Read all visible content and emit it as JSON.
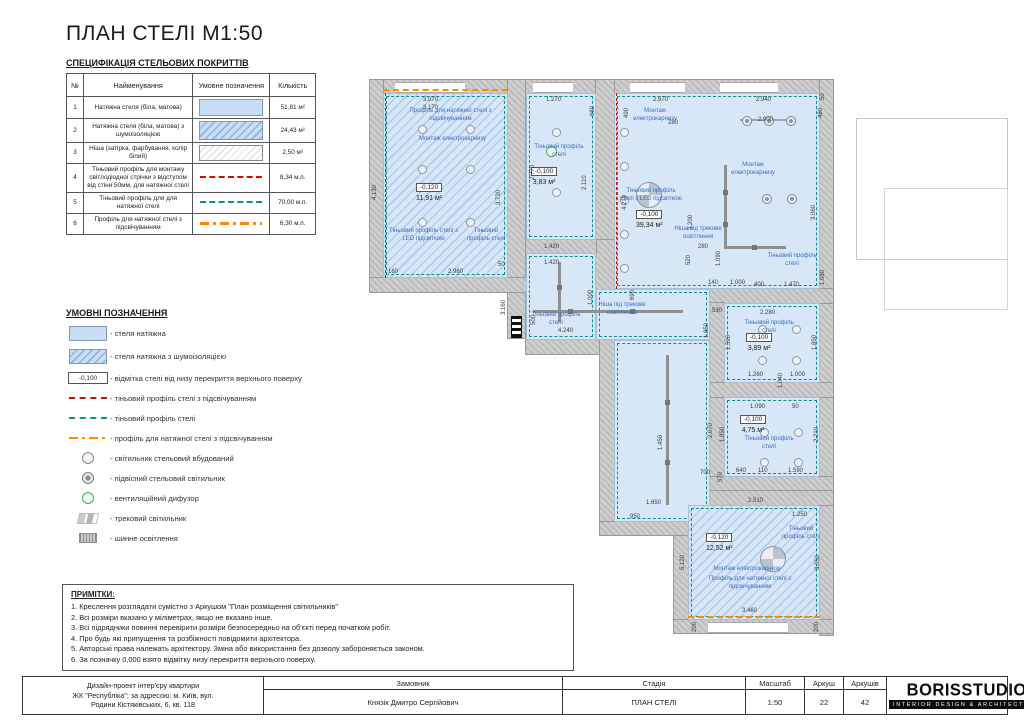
{
  "title": "ПЛАН СТЕЛІ М1:50",
  "colors": {
    "ceiling_fill": "#d8e7f8",
    "teal_profile": "#0d8f8f",
    "red_profile": "#cc1100",
    "orange_profile": "#ff8a00",
    "annotation_blue": "#3a6bbf",
    "diffuser_green": "#44b04a",
    "wall_gray": "#cfcfcf"
  },
  "spec_table": {
    "title": "СПЕЦИФІКАЦІЯ СТЕЛЬОВИХ ПОКРИТТІВ",
    "headers": [
      "№",
      "Найменування",
      "Умовне позначення",
      "Кількість"
    ],
    "rows": [
      {
        "no": "1",
        "name": "Натяжна стеля (біла, матова)",
        "swatch": "ceiling-plain",
        "qty": "51,81 м²"
      },
      {
        "no": "2",
        "name": "Натяжна стеля (біла, матова) з шумоізоляцією",
        "swatch": "ceiling-noise",
        "qty": "24,43 м²"
      },
      {
        "no": "3",
        "name": "Ніша (затірка, фарбування, колір білий)",
        "swatch": "niche-hatch",
        "qty": "2,50 м²"
      },
      {
        "no": "4",
        "name": "Тіньовий профіль для монтажу світлодіодної стрічки з відступом від стіни 50мм, для натяжної стелі",
        "swatch": "red-dashed",
        "qty": "8,34 м.п."
      },
      {
        "no": "5",
        "name": "Тіньовий профіль для для натяжної стелі",
        "swatch": "teal-dashed",
        "qty": "70,00 м.п."
      },
      {
        "no": "6",
        "name": "Профіль для натяжної стелі з підсвічуванням",
        "swatch": "orange-dashdot",
        "qty": "6,30 м.п."
      }
    ]
  },
  "legend": {
    "title": "УМОВНІ ПОЗНАЧЕННЯ",
    "items": [
      {
        "icon": "ceiling-plain",
        "label": "- стеля натяжна"
      },
      {
        "icon": "ceiling-noise",
        "label": "- стеля натяжна з шумоізоляцією"
      },
      {
        "icon": "elev-box",
        "icon_text": "-0,100",
        "label": "- відмітка стелі від низу перекриття верхнього поверху"
      },
      {
        "icon": "red-dashed",
        "label": "- тіньовий профіль стелі з підсвічуванням"
      },
      {
        "icon": "teal-dashed",
        "label": "- тіньовий профіль стелі"
      },
      {
        "icon": "orange-dashdot",
        "label": "- профіль для натяжної стелі з підсвічуванням"
      },
      {
        "icon": "downlight",
        "label": "- світильник стельовий вбудований"
      },
      {
        "icon": "pendant",
        "label": "- підвісний стельовий світильник"
      },
      {
        "icon": "diffuser",
        "label": "- вентиляційний дифузор"
      },
      {
        "icon": "track",
        "label": "- трековий світильник"
      },
      {
        "icon": "busbar",
        "label": "- шинне освітлення"
      }
    ]
  },
  "notes": {
    "title": "ПРИМІТКИ:",
    "lines": [
      "1. Креслення розглядати сумістно з Аркушом \"План розміщення світильників\"",
      "2. Всі розміри вказано у міліметрах, якщо не вказано інше.",
      "3. Всі підрядники повинні перевірити розміри безпосередньо на об'єкті перед початком робіт.",
      "4. Про будь які припущення та розбіжності повідомити архітектора.",
      "5. Авторські права належать архітектору. Зміна або використання без дозволу забороняється законом.",
      "6. За позначку 0,000 взято відмітку низу перекриття верхнього поверху."
    ]
  },
  "title_block": {
    "project_lines": [
      "Дизайн-проект інтер'єру квартири",
      "ЖК \"Республіка\"; за адресою: м. Київ, вул.",
      "Родини Кістяківських, 6, кв. 118"
    ],
    "client_label": "Замовник",
    "client_value": "Князік Дмитро Сергійович",
    "stage_label": "Стадія",
    "stage_value": "ПЛАН СТЕЛІ",
    "scale_label": "Масштаб",
    "scale_value": "1:50",
    "sheet_label": "Аркуш",
    "sheet_value": "22",
    "sheets_label": "Аркушів",
    "sheets_value": "42",
    "logo": "BORISSTUDIO",
    "logo_sub": "INTERIOR DESIGN & ARCHITECTURE"
  },
  "plan": {
    "rooms": [
      {
        "elev": "-0,120",
        "area": "11,91 м²",
        "x": 48,
        "y": 106
      },
      {
        "elev": "-0,100",
        "area": "3,83 м²",
        "x": 163,
        "y": 90
      },
      {
        "elev": "-0,100",
        "area": "39,34 м²",
        "x": 268,
        "y": 133
      },
      {
        "elev": "-0,100",
        "area": "3,89 м²",
        "x": 378,
        "y": 256
      },
      {
        "elev": "-0,100",
        "area": "4,75 м²",
        "x": 372,
        "y": 338
      },
      {
        "elev": "-0,120",
        "area": "12,52 м²",
        "x": 338,
        "y": 456
      }
    ],
    "annotations": [
      {
        "t": "Профіль для натяжної стелі з підсвічуванням",
        "x": 35,
        "y": 38,
        "w": 95
      },
      {
        "t": "Монтаж електрокарнизу",
        "x": 42,
        "y": 66,
        "w": 85
      },
      {
        "t": "Тіньовий профіль стелі з LED підсвіткою",
        "x": 18,
        "y": 158,
        "w": 75
      },
      {
        "t": "Тіньовий профіль стелі",
        "x": 96,
        "y": 158,
        "w": 44
      },
      {
        "t": "Тіньовий профіль стелі",
        "x": 160,
        "y": 74,
        "w": 62
      },
      {
        "t": "Монтаж електрокарнизу",
        "x": 256,
        "y": 38,
        "w": 62
      },
      {
        "t": "Тіньовий профіль стелі з LED підсвіткою",
        "x": 252,
        "y": 118,
        "w": 62
      },
      {
        "t": "Монтаж електрокарнизу",
        "x": 352,
        "y": 92,
        "w": 66
      },
      {
        "t": "Тіньовий профіль стелі",
        "x": 398,
        "y": 183,
        "w": 52
      },
      {
        "t": "Ніша під трекове освітлення",
        "x": 298,
        "y": 156,
        "w": 64
      },
      {
        "t": "Ніша під трекове освітлення",
        "x": 220,
        "y": 232,
        "w": 68
      },
      {
        "t": "Тіньовий профіль стелі",
        "x": 160,
        "y": 242,
        "w": 56
      },
      {
        "t": "Тіньовий профіль стелі",
        "x": 376,
        "y": 250,
        "w": 50
      },
      {
        "t": "Тіньовий профіль стелі",
        "x": 376,
        "y": 366,
        "w": 50
      },
      {
        "t": "Тіньовий профіль стелі",
        "x": 410,
        "y": 456,
        "w": 46
      },
      {
        "t": "Монтаж електрокарнизу",
        "x": 336,
        "y": 496,
        "w": 86
      },
      {
        "t": "Профіль для натяжної стелі з підсвічуванням",
        "x": 330,
        "y": 506,
        "w": 104
      }
    ],
    "dims": [
      {
        "t": "3.070",
        "x": 55,
        "y": 27
      },
      {
        "t": "3.170",
        "x": 55,
        "y": 35
      },
      {
        "t": "1.270",
        "x": 178,
        "y": 27
      },
      {
        "t": "660",
        "x": 222,
        "y": 46,
        "v": true
      },
      {
        "t": "2.970",
        "x": 285,
        "y": 27
      },
      {
        "t": "490",
        "x": 256,
        "y": 48,
        "v": true
      },
      {
        "t": "280",
        "x": 300,
        "y": 50
      },
      {
        "t": "2.940",
        "x": 388,
        "y": 27
      },
      {
        "t": "2.900",
        "x": 390,
        "y": 47
      },
      {
        "t": "480",
        "x": 450,
        "y": 48,
        "v": true
      },
      {
        "t": "4.130",
        "x": 4,
        "y": 130,
        "v": true
      },
      {
        "t": "3.730",
        "x": 128,
        "y": 135,
        "v": true
      },
      {
        "t": "2.770",
        "x": 162,
        "y": 110,
        "v": true
      },
      {
        "t": "2.110",
        "x": 214,
        "y": 120,
        "v": true
      },
      {
        "t": "4.210",
        "x": 254,
        "y": 140,
        "v": true
      },
      {
        "t": "3.200",
        "x": 320,
        "y": 160,
        "v": true
      },
      {
        "t": "3.060",
        "x": 443,
        "y": 150,
        "v": true
      },
      {
        "t": "160",
        "x": 20,
        "y": 199
      },
      {
        "t": "2.960",
        "x": 80,
        "y": 199
      },
      {
        "t": "50",
        "x": 130,
        "y": 192
      },
      {
        "t": "1.420",
        "x": 176,
        "y": 174
      },
      {
        "t": "1.420",
        "x": 176,
        "y": 190
      },
      {
        "t": "1.000",
        "x": 220,
        "y": 235,
        "v": true
      },
      {
        "t": "500",
        "x": 163,
        "y": 255,
        "v": true
      },
      {
        "t": "3.160",
        "x": 133,
        "y": 245,
        "v": true
      },
      {
        "t": "4.240",
        "x": 190,
        "y": 258
      },
      {
        "t": "690",
        "x": 262,
        "y": 230,
        "v": true
      },
      {
        "t": "520",
        "x": 318,
        "y": 195,
        "v": true
      },
      {
        "t": "280",
        "x": 330,
        "y": 174
      },
      {
        "t": "1.090",
        "x": 348,
        "y": 196,
        "v": true
      },
      {
        "t": "1.000",
        "x": 362,
        "y": 210
      },
      {
        "t": "140",
        "x": 340,
        "y": 210
      },
      {
        "t": "530",
        "x": 344,
        "y": 238
      },
      {
        "t": "400",
        "x": 386,
        "y": 212
      },
      {
        "t": "1.470",
        "x": 416,
        "y": 212
      },
      {
        "t": "1.080",
        "x": 452,
        "y": 215,
        "v": true
      },
      {
        "t": "2.280",
        "x": 392,
        "y": 240
      },
      {
        "t": "1.590",
        "x": 358,
        "y": 280,
        "v": true
      },
      {
        "t": "1.850",
        "x": 444,
        "y": 280,
        "v": true
      },
      {
        "t": "1.260",
        "x": 380,
        "y": 302
      },
      {
        "t": "1.000",
        "x": 422,
        "y": 302
      },
      {
        "t": "1.040",
        "x": 410,
        "y": 318,
        "v": true
      },
      {
        "t": "1.850",
        "x": 336,
        "y": 268,
        "v": true
      },
      {
        "t": "1.450",
        "x": 290,
        "y": 380,
        "v": true
      },
      {
        "t": "1.650",
        "x": 278,
        "y": 430
      },
      {
        "t": "700",
        "x": 332,
        "y": 400
      },
      {
        "t": "570",
        "x": 350,
        "y": 412,
        "v": true
      },
      {
        "t": "1.090",
        "x": 382,
        "y": 334
      },
      {
        "t": "50",
        "x": 424,
        "y": 334
      },
      {
        "t": "1.850",
        "x": 352,
        "y": 372,
        "v": true
      },
      {
        "t": "2.210",
        "x": 446,
        "y": 372,
        "v": true
      },
      {
        "t": "2.070",
        "x": 340,
        "y": 368,
        "v": true
      },
      {
        "t": "640",
        "x": 368,
        "y": 398
      },
      {
        "t": "110",
        "x": 390,
        "y": 398
      },
      {
        "t": "1.590",
        "x": 420,
        "y": 398
      },
      {
        "t": "2.510",
        "x": 380,
        "y": 428
      },
      {
        "t": "1.250",
        "x": 424,
        "y": 442
      },
      {
        "t": "950",
        "x": 262,
        "y": 444
      },
      {
        "t": "5.120",
        "x": 312,
        "y": 500,
        "v": true
      },
      {
        "t": "3.050",
        "x": 447,
        "y": 500,
        "v": true
      },
      {
        "t": "3.460",
        "x": 374,
        "y": 538
      },
      {
        "t": "200",
        "x": 324,
        "y": 562,
        "v": true
      },
      {
        "t": "200",
        "x": 446,
        "y": 562,
        "v": true
      },
      {
        "t": "50",
        "x": 452,
        "y": 30,
        "v": true
      }
    ]
  }
}
